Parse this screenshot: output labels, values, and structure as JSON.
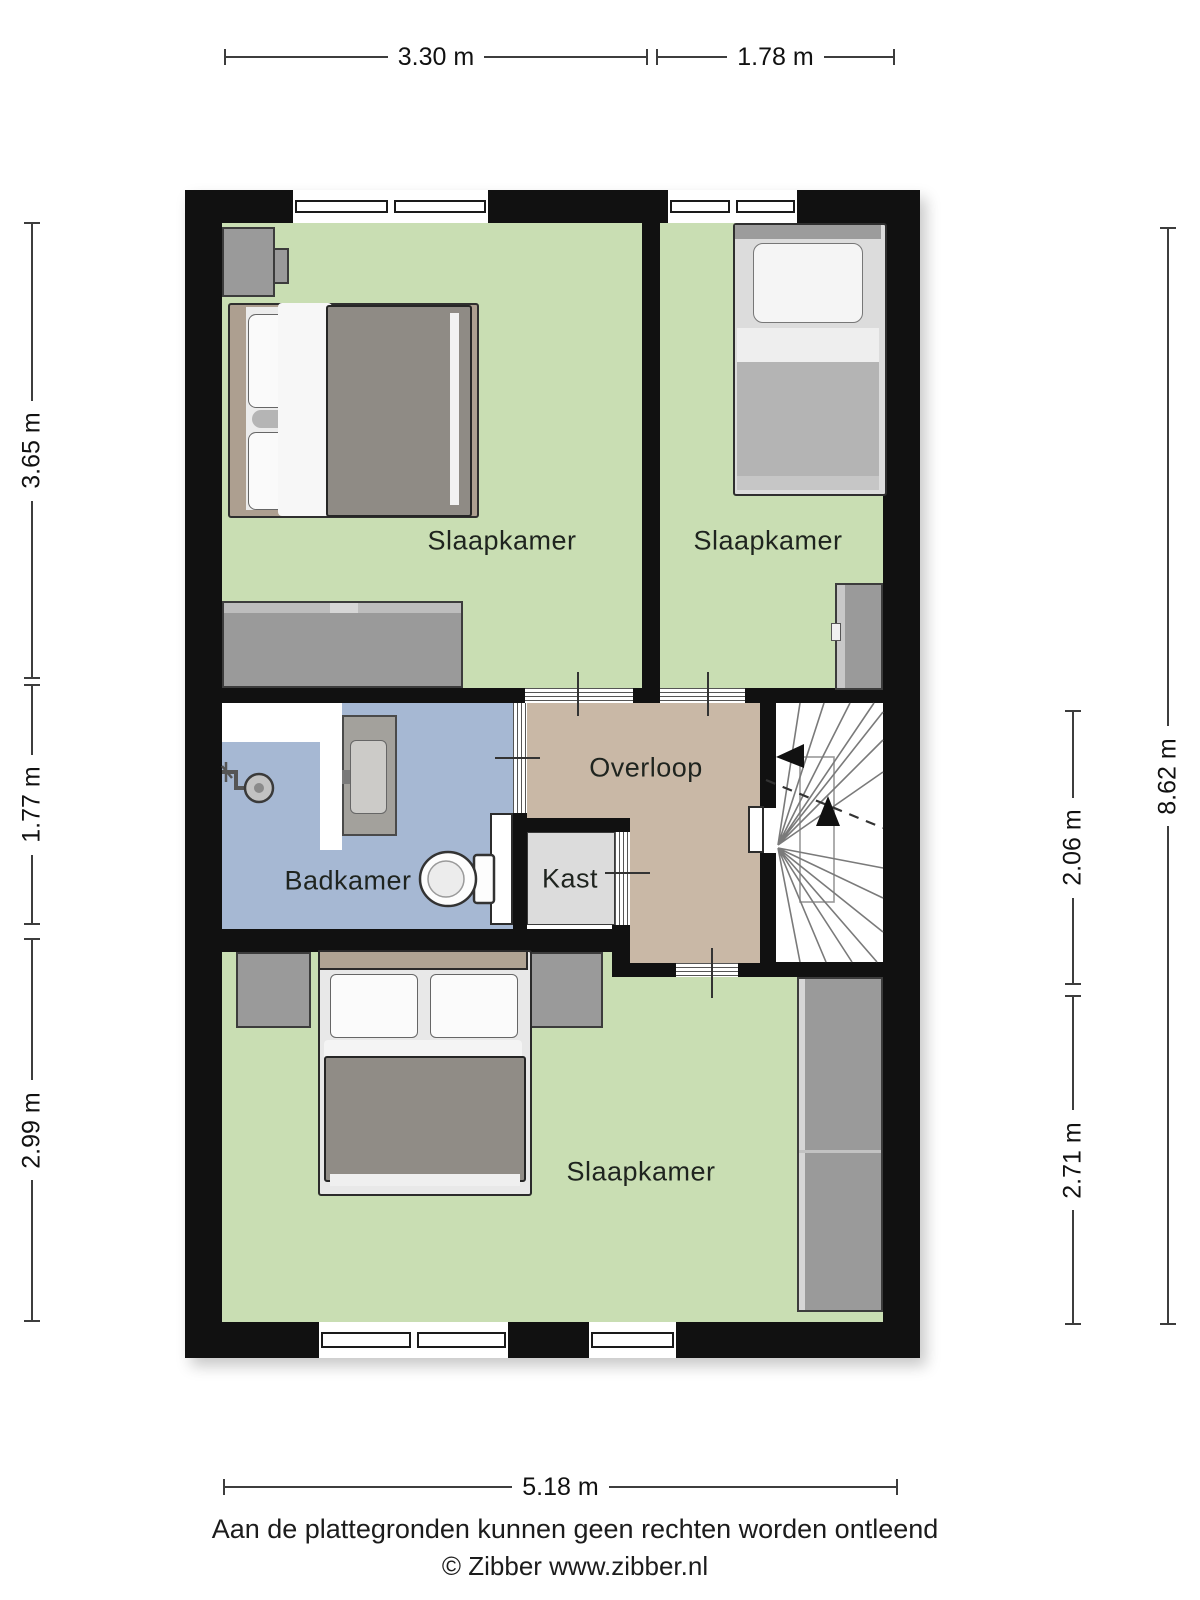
{
  "colors": {
    "wall": "#111111",
    "bedroom_floor": "#c9deb3",
    "bathroom_floor": "#a6b8d3",
    "hall_floor": "#c9b8a6",
    "closet_floor": "#dcdcdc",
    "stairs_floor": "#ffffff",
    "furniture": "#9a9a9a",
    "label_text": "#1f241f",
    "dim_text": "#111111"
  },
  "rooms": [
    {
      "id": "slaapkamer-1",
      "label": "Slaapkamer"
    },
    {
      "id": "slaapkamer-2",
      "label": "Slaapkamer"
    },
    {
      "id": "badkamer",
      "label": "Badkamer"
    },
    {
      "id": "overloop",
      "label": "Overloop"
    },
    {
      "id": "kast",
      "label": "Kast"
    },
    {
      "id": "slaapkamer-3",
      "label": "Slaapkamer"
    }
  ],
  "dimensions": {
    "top": [
      "3.30 m",
      "1.78 m"
    ],
    "left": [
      "3.65 m",
      "1.77 m",
      "2.99 m"
    ],
    "right_inner": [
      "2.06 m",
      "2.71 m"
    ],
    "right_outer": "8.62 m",
    "bottom": "5.18 m"
  },
  "footer": {
    "disclaimer": "Aan de plattegronden kunnen geen rechten worden ontleend",
    "copyright": "© Zibber www.zibber.nl"
  }
}
